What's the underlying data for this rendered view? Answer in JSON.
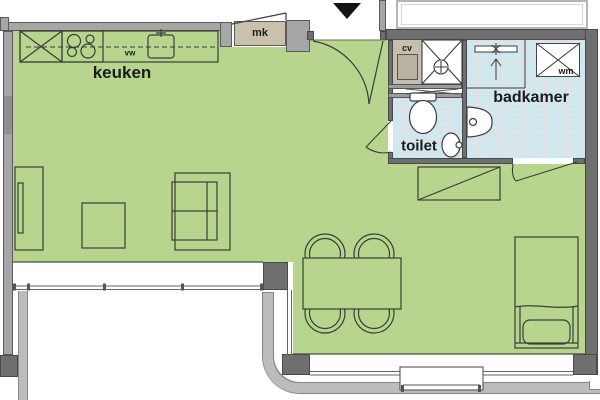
{
  "plan_title": "apartment floor plan",
  "labels": {
    "kitchen": "keuken",
    "bathroom": "badkamer",
    "toilet": "toilet",
    "meter_cupboard": "mk",
    "central_heating": "cv",
    "dishwasher": "vw",
    "washing_machine": "wm"
  },
  "colors": {
    "floor_green": "#b7d58d",
    "tile_blue": "#cfe9ef",
    "wall_light": "#a6a6a6",
    "wall_dark": "#6f6f6f",
    "railing_gray": "#bcbcbc",
    "cabinet_beige": "#c9c1ac",
    "line_dark": "#3c3c3c",
    "entrance_marker": "#141414"
  }
}
